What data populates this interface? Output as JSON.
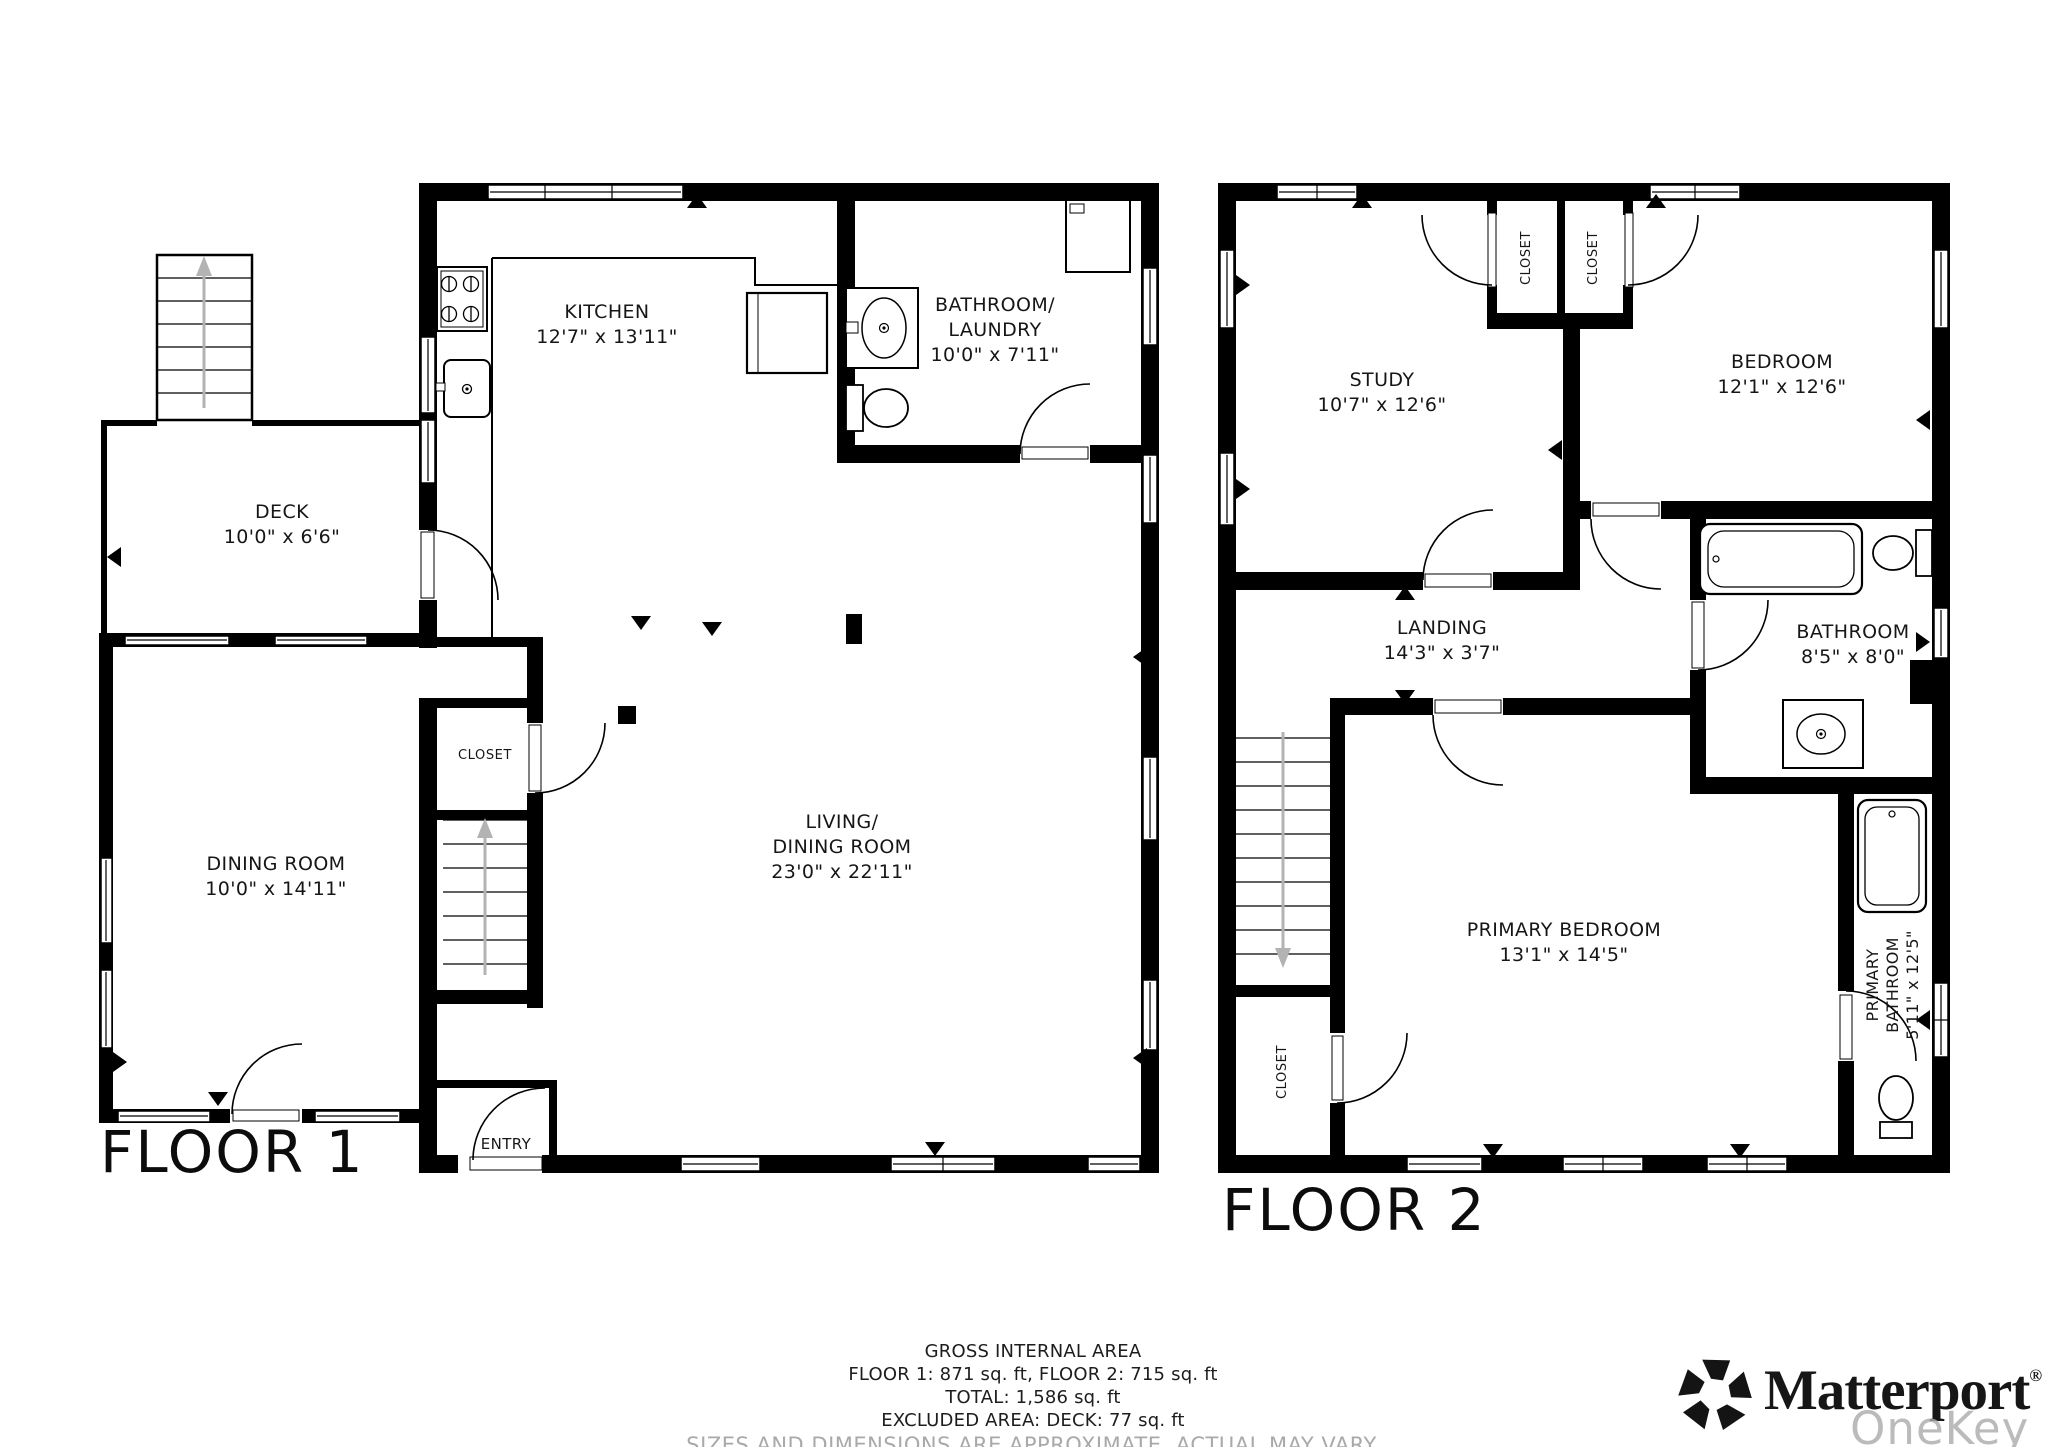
{
  "floor1": {
    "title": "FLOOR 1",
    "kitchen": {
      "name": "KITCHEN",
      "dims": "12'7\" x 13'11\""
    },
    "bath_laundry": {
      "line1": "BATHROOM/",
      "line2": "LAUNDRY",
      "dims": "10'0\" x 7'11\""
    },
    "deck": {
      "name": "DECK",
      "dims": "10'0\" x 6'6\""
    },
    "dining": {
      "name": "DINING ROOM",
      "dims": "10'0\" x 14'11\""
    },
    "living": {
      "line1": "LIVING/",
      "line2": "DINING ROOM",
      "dims": "23'0\" x 22'11\""
    },
    "closet": {
      "name": "CLOSET"
    },
    "entry": {
      "name": "ENTRY"
    }
  },
  "floor2": {
    "title": "FLOOR 2",
    "study": {
      "name": "STUDY",
      "dims": "10'7\" x 12'6\""
    },
    "bedroom": {
      "name": "BEDROOM",
      "dims": "12'1\" x 12'6\""
    },
    "closet_a": {
      "name": "CLOSET"
    },
    "closet_b": {
      "name": "CLOSET"
    },
    "closet_c": {
      "name": "CLOSET"
    },
    "landing": {
      "name": "LANDING",
      "dims": "14'3\" x 3'7\""
    },
    "bathroom": {
      "name": "BATHROOM",
      "dims": "8'5\" x 8'0\""
    },
    "primary_bedroom": {
      "name": "PRIMARY BEDROOM",
      "dims": "13'1\" x 14'5\""
    },
    "primary_bathroom": {
      "line1": "PRIMARY",
      "line2": "BATHROOM",
      "dims": "5'11\" x 12'5\""
    }
  },
  "footer": {
    "title": "GROSS INTERNAL AREA",
    "floors": "FLOOR 1: 871 sq. ft, FLOOR 2: 715 sq. ft",
    "total": "TOTAL: 1,586 sq. ft",
    "excluded": "EXCLUDED AREA: DECK: 77 sq. ft",
    "disclaimer": "SIZES AND DIMENSIONS ARE APPROXIMATE, ACTUAL MAY VARY."
  },
  "branding": {
    "wordmark": "Matterport",
    "reg": "®",
    "watermark": "OneKey MLS"
  },
  "colors": {
    "wall": "#000000",
    "stair_arrow": "#b3b3b3",
    "disclaimer_gray": "#a9a9a9",
    "watermark_gray": "#aaaaaa"
  }
}
